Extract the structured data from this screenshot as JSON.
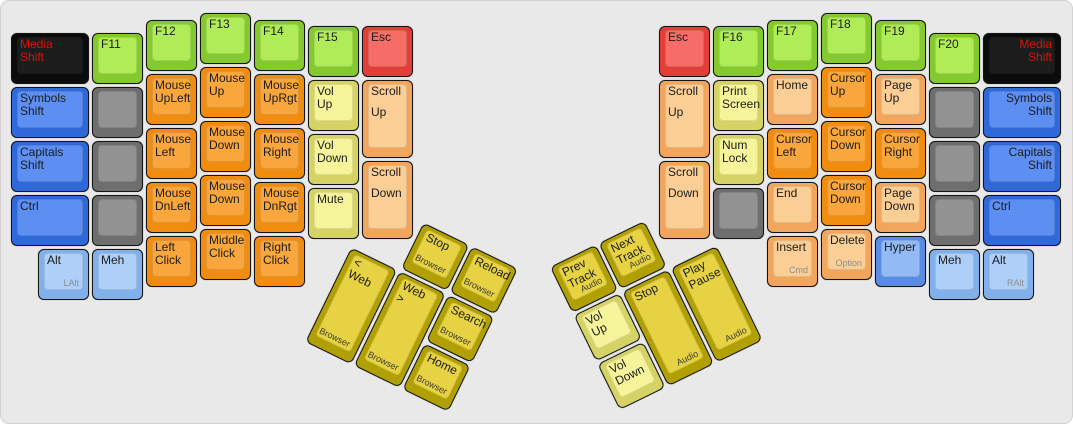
{
  "board": {
    "width": 1073,
    "height": 424,
    "background": "#e9e9e9"
  },
  "palette": {
    "black": {
      "outer": "#0b0b0b",
      "inner": "#1c1c1c",
      "text": "#dd1405"
    },
    "blue": {
      "outer": "#2f68d8",
      "inner": "#5d8ef2"
    },
    "midblue": {
      "outer": "#5a8ce6",
      "inner": "#92baf5"
    },
    "lightblue": {
      "outer": "#82b0ea",
      "inner": "#aed0f8"
    },
    "gray": {
      "outer": "#6e6e6e",
      "inner": "#929292"
    },
    "green": {
      "outer": "#83c92f",
      "inner": "#b0ec58"
    },
    "orange": {
      "outer": "#f08d10",
      "inner": "#f9a63c"
    },
    "peach": {
      "outer": "#f2a65d",
      "inner": "#fbce96"
    },
    "paleyellow": {
      "outer": "#d5d266",
      "inner": "#f6f49a"
    },
    "gold": {
      "outer": "#b1a003",
      "inner": "#e6d243"
    },
    "red": {
      "outer": "#e33d38",
      "inner": "#f56d66"
    }
  },
  "keys": [
    {
      "name": "key-media-shift-left",
      "x": 10,
      "y": 32,
      "w": 78,
      "color": "black",
      "label": "Media\nShift"
    },
    {
      "name": "key-symbols-shift-left",
      "x": 10,
      "y": 86,
      "w": 78,
      "color": "blue",
      "label": "Symbols\nShift"
    },
    {
      "name": "key-capitals-shift-left",
      "x": 10,
      "y": 140,
      "w": 78,
      "color": "blue",
      "label": "Capitals\nShift"
    },
    {
      "name": "key-ctrl-left",
      "x": 10,
      "y": 194,
      "w": 78,
      "color": "blue",
      "label": "Ctrl"
    },
    {
      "name": "key-f11",
      "x": 91,
      "y": 32,
      "color": "green",
      "label": "F11"
    },
    {
      "name": "key-blank-left-1",
      "x": 91,
      "y": 86,
      "color": "gray",
      "label": ""
    },
    {
      "name": "key-blank-left-2",
      "x": 91,
      "y": 140,
      "color": "gray",
      "label": ""
    },
    {
      "name": "key-blank-left-3",
      "x": 91,
      "y": 194,
      "color": "gray",
      "label": ""
    },
    {
      "name": "key-f12",
      "x": 145,
      "y": 19,
      "color": "green",
      "label": "F12"
    },
    {
      "name": "key-mouse-upleft",
      "x": 145,
      "y": 73,
      "color": "orange",
      "label": "Mouse\nUpLeft"
    },
    {
      "name": "key-mouse-left",
      "x": 145,
      "y": 127,
      "color": "orange",
      "label": "Mouse\nLeft"
    },
    {
      "name": "key-mouse-dnleft",
      "x": 145,
      "y": 181,
      "color": "orange",
      "label": "Mouse\nDnLeft"
    },
    {
      "name": "key-left-click",
      "x": 145,
      "y": 235,
      "color": "orange",
      "label": "Left\nClick"
    },
    {
      "name": "key-f13",
      "x": 199,
      "y": 12,
      "color": "green",
      "label": "F13"
    },
    {
      "name": "key-mouse-up",
      "x": 199,
      "y": 66,
      "color": "orange",
      "label": "Mouse\nUp"
    },
    {
      "name": "key-mouse-down-1",
      "x": 199,
      "y": 120,
      "color": "orange",
      "label": "Mouse\nDown"
    },
    {
      "name": "key-mouse-down-2",
      "x": 199,
      "y": 174,
      "color": "orange",
      "label": "Mouse\nDown"
    },
    {
      "name": "key-middle-click",
      "x": 199,
      "y": 228,
      "color": "orange",
      "label": "Middle\nClick"
    },
    {
      "name": "key-f14",
      "x": 253,
      "y": 19,
      "color": "green",
      "label": "F14"
    },
    {
      "name": "key-mouse-uprgt",
      "x": 253,
      "y": 73,
      "color": "orange",
      "label": "Mouse\nUpRgt"
    },
    {
      "name": "key-mouse-right",
      "x": 253,
      "y": 127,
      "color": "orange",
      "label": "Mouse\nRight"
    },
    {
      "name": "key-mouse-dnrgt",
      "x": 253,
      "y": 181,
      "color": "orange",
      "label": "Mouse\nDnRgt"
    },
    {
      "name": "key-right-click",
      "x": 253,
      "y": 235,
      "color": "orange",
      "label": "Right\nClick"
    },
    {
      "name": "key-f15",
      "x": 307,
      "y": 25,
      "color": "green",
      "label": "F15"
    },
    {
      "name": "key-vol-up-left",
      "x": 307,
      "y": 79,
      "color": "paleyellow",
      "label": "Vol\nUp"
    },
    {
      "name": "key-vol-down-left",
      "x": 307,
      "y": 133,
      "color": "paleyellow",
      "label": "Vol\nDown"
    },
    {
      "name": "key-mute",
      "x": 307,
      "y": 187,
      "color": "paleyellow",
      "label": "Mute"
    },
    {
      "name": "key-esc-left",
      "x": 361,
      "y": 25,
      "color": "red",
      "label": "Esc"
    },
    {
      "name": "key-scroll-up-left",
      "x": 361,
      "y": 79,
      "h": 78,
      "color": "peach",
      "label": "Scroll",
      "label2": "Up"
    },
    {
      "name": "key-scroll-down-left",
      "x": 361,
      "y": 160,
      "h": 78,
      "color": "peach",
      "label": "Scroll",
      "label2": "Down"
    },
    {
      "name": "key-alt-left",
      "x": 37,
      "y": 248,
      "color": "lightblue",
      "label": "Alt",
      "sub": "LAlt",
      "subMuted": true
    },
    {
      "name": "key-meh-left",
      "x": 91,
      "y": 248,
      "color": "lightblue",
      "label": "Meh"
    },
    {
      "name": "key-esc-right",
      "x": 658,
      "y": 25,
      "color": "red",
      "label": "Esc"
    },
    {
      "name": "key-scroll-up-right",
      "x": 658,
      "y": 79,
      "h": 78,
      "color": "peach",
      "label": "Scroll",
      "label2": "Up"
    },
    {
      "name": "key-scroll-down-right",
      "x": 658,
      "y": 160,
      "h": 78,
      "color": "peach",
      "label": "Scroll",
      "label2": "Down"
    },
    {
      "name": "key-f16",
      "x": 712,
      "y": 25,
      "color": "green",
      "label": "F16"
    },
    {
      "name": "key-print-screen",
      "x": 712,
      "y": 79,
      "color": "paleyellow",
      "label": "Print\nScreen"
    },
    {
      "name": "key-num-lock",
      "x": 712,
      "y": 133,
      "color": "paleyellow",
      "label": "Num\nLock"
    },
    {
      "name": "key-blank-right-1",
      "x": 712,
      "y": 187,
      "color": "gray",
      "label": ""
    },
    {
      "name": "key-f17",
      "x": 766,
      "y": 19,
      "color": "green",
      "label": "F17"
    },
    {
      "name": "key-home",
      "x": 766,
      "y": 73,
      "color": "peach",
      "label": "Home"
    },
    {
      "name": "key-cursor-left",
      "x": 766,
      "y": 127,
      "color": "orange",
      "label": "Cursor\nLeft"
    },
    {
      "name": "key-end",
      "x": 766,
      "y": 181,
      "color": "peach",
      "label": "End"
    },
    {
      "name": "key-insert",
      "x": 766,
      "y": 235,
      "color": "peach",
      "label": "Insert",
      "sub": "Cmd",
      "subMuted": true
    },
    {
      "name": "key-f18",
      "x": 820,
      "y": 12,
      "color": "green",
      "label": "F18"
    },
    {
      "name": "key-cursor-up",
      "x": 820,
      "y": 66,
      "color": "orange",
      "label": "Cursor\nUp"
    },
    {
      "name": "key-cursor-down-1",
      "x": 820,
      "y": 120,
      "color": "orange",
      "label": "Cursor\nDown"
    },
    {
      "name": "key-cursor-down-2",
      "x": 820,
      "y": 174,
      "color": "orange",
      "label": "Cursor\nDown"
    },
    {
      "name": "key-delete",
      "x": 820,
      "y": 228,
      "color": "peach",
      "label": "Delete",
      "sub": "Option",
      "subMuted": true
    },
    {
      "name": "key-f19",
      "x": 874,
      "y": 19,
      "color": "green",
      "label": "F19"
    },
    {
      "name": "key-page-up",
      "x": 874,
      "y": 73,
      "color": "peach",
      "label": "Page\nUp"
    },
    {
      "name": "key-cursor-right",
      "x": 874,
      "y": 127,
      "color": "orange",
      "label": "Cursor\nRight"
    },
    {
      "name": "key-page-down",
      "x": 874,
      "y": 181,
      "color": "peach",
      "label": "Page\nDown"
    },
    {
      "name": "key-hyper",
      "x": 874,
      "y": 235,
      "color": "midblue",
      "label": "Hyper"
    },
    {
      "name": "key-f20",
      "x": 928,
      "y": 32,
      "color": "green",
      "label": "F20"
    },
    {
      "name": "key-blank-right-2",
      "x": 928,
      "y": 86,
      "color": "gray",
      "label": ""
    },
    {
      "name": "key-blank-right-3",
      "x": 928,
      "y": 140,
      "color": "gray",
      "label": ""
    },
    {
      "name": "key-blank-right-4",
      "x": 928,
      "y": 194,
      "color": "gray",
      "label": ""
    },
    {
      "name": "key-meh-right",
      "x": 928,
      "y": 248,
      "color": "lightblue",
      "label": "Meh"
    },
    {
      "name": "key-media-shift-right",
      "x": 982,
      "y": 32,
      "w": 78,
      "color": "black",
      "label": "Media\nShift",
      "align": "right"
    },
    {
      "name": "key-symbols-shift-right",
      "x": 982,
      "y": 86,
      "w": 78,
      "color": "blue",
      "label": "Symbols\nShift",
      "align": "right"
    },
    {
      "name": "key-capitals-shift-right",
      "x": 982,
      "y": 140,
      "w": 78,
      "color": "blue",
      "label": "Capitals\nShift",
      "align": "right"
    },
    {
      "name": "key-ctrl-right",
      "x": 982,
      "y": 194,
      "w": 78,
      "color": "blue",
      "label": "Ctrl"
    },
    {
      "name": "key-alt-right",
      "x": 982,
      "y": 248,
      "color": "lightblue",
      "label": "Alt",
      "sub": "RAlt",
      "subMuted": true
    }
  ],
  "thumb_left": {
    "x": 374,
    "y": 198,
    "angle": 26,
    "keys": [
      {
        "name": "key-browser-stop",
        "x": 54,
        "y": 0,
        "color": "gold",
        "label": "Stop",
        "sub": "Browser"
      },
      {
        "name": "key-browser-reload",
        "x": 108,
        "y": 0,
        "color": "gold",
        "label": "Reload",
        "sub": "Browser"
      },
      {
        "name": "key-web-back",
        "x": 0,
        "y": 54,
        "h": 105,
        "color": "gold",
        "label": "< Web",
        "sub": "Browser"
      },
      {
        "name": "key-web-forward",
        "x": 54,
        "y": 54,
        "h": 105,
        "color": "gold",
        "label": "Web >",
        "sub": "Browser"
      },
      {
        "name": "key-browser-search",
        "x": 108,
        "y": 54,
        "color": "gold",
        "label": "Search",
        "sub": "Browser"
      },
      {
        "name": "key-browser-home",
        "x": 108,
        "y": 108,
        "color": "gold",
        "label": "Home",
        "sub": "Browser"
      }
    ]
  },
  "thumb_right": {
    "x": 549,
    "y": 266,
    "angle": -26,
    "keys": [
      {
        "name": "key-prev-track",
        "x": 0,
        "y": 0,
        "color": "gold",
        "label": "Prev\nTrack",
        "sub": "Audio"
      },
      {
        "name": "key-next-track",
        "x": 54,
        "y": 0,
        "color": "gold",
        "label": "Next\nTrack",
        "sub": "Audio"
      },
      {
        "name": "key-thumb-vol-up",
        "x": 0,
        "y": 54,
        "color": "paleyellow",
        "label": "Vol\nUp"
      },
      {
        "name": "key-audio-stop",
        "x": 54,
        "y": 54,
        "h": 105,
        "color": "gold",
        "label": "Stop",
        "sub": "Audio"
      },
      {
        "name": "key-play-pause",
        "x": 108,
        "y": 54,
        "h": 105,
        "color": "gold",
        "label": "Play\nPause",
        "sub": "Audio"
      },
      {
        "name": "key-thumb-vol-down",
        "x": 0,
        "y": 108,
        "color": "paleyellow",
        "label": "Vol\nDown"
      }
    ]
  }
}
